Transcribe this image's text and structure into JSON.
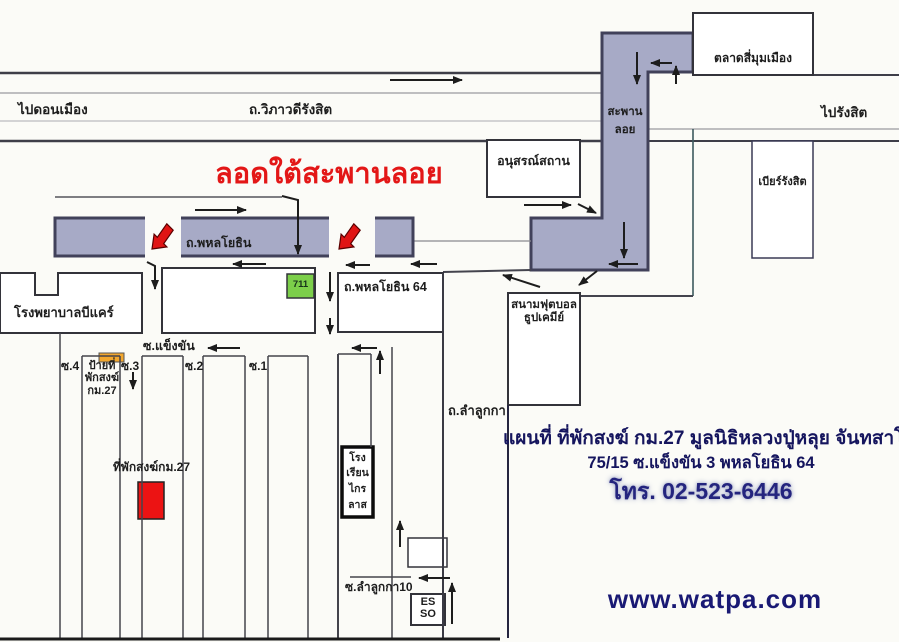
{
  "map": {
    "top_roads": {
      "to_don_mueang": "ไปดอนเมือง",
      "vibhavadi_rangsit_road": "ถ.วิภาวดีรังสิต",
      "to_rangsit": "ไปรังสิต"
    },
    "flyover": {
      "line1": "สะพาน",
      "line2": "ลอย"
    },
    "landmarks": {
      "si_mum_mueang_market": "ตลาดสี่มุมเมือง",
      "memorial": "อนุสรณ์สถาน",
      "beer_rangsit": "เบียร์รังสิต",
      "b_care_hospital": "โรงพยาบาลบีแคร์",
      "seven_eleven": "711",
      "football_field_line1": "สนามฟุตบอล",
      "football_field_line2": "ธูปเคมีย์",
      "school_line1": "โรง",
      "school_line2": "เรียน",
      "school_line3": "ไกร",
      "school_line4": "ลาส",
      "esso_line1": "ES",
      "esso_line2": "SO"
    },
    "roads": {
      "phahonyothin": "ถ.พหลโยธิน",
      "phahonyothin_64": "ถ.พหลโยธิน 64",
      "soi_khaeng_khan": "ซ.แข็งขัน",
      "lam_luk_ka_road": "ถ.ลำลูกกา",
      "soi_lam_luk_ka_10": "ซ.ลำลูกกา10",
      "soi_4": "ซ.4",
      "soi_3": "ซ.3",
      "soi_2": "ซ.2",
      "soi_1": "ซ.1"
    },
    "route_notes": {
      "pass_under_flyover": "ลอดใต้สะพานลอย",
      "monk_sign_line1": "ป้ายที่",
      "monk_sign_line2": "พักสงฆ์",
      "monk_sign_line3": "กม.27",
      "monk_residence": "ที่พักสงฆ์กม.27"
    }
  },
  "info_panel": {
    "title": "แผนที่ ที่พักสงฆ์ กม.27 มูลนิธิหลวงปู่หลุย จันทสาโร",
    "address": "75/15 ซ.แข็งขัน 3 พหลโยธิน 64",
    "phone": "โทร. 02-523-6446",
    "website": "www.watpa.com"
  },
  "colors": {
    "flyover_gray": "#a7aac6",
    "route_red": "#e01414",
    "seven_eleven_green": "#7ccf4a",
    "sign_yellow": "#f2a72e",
    "residence_red": "#ec1313",
    "info_navy": "#15155e"
  }
}
